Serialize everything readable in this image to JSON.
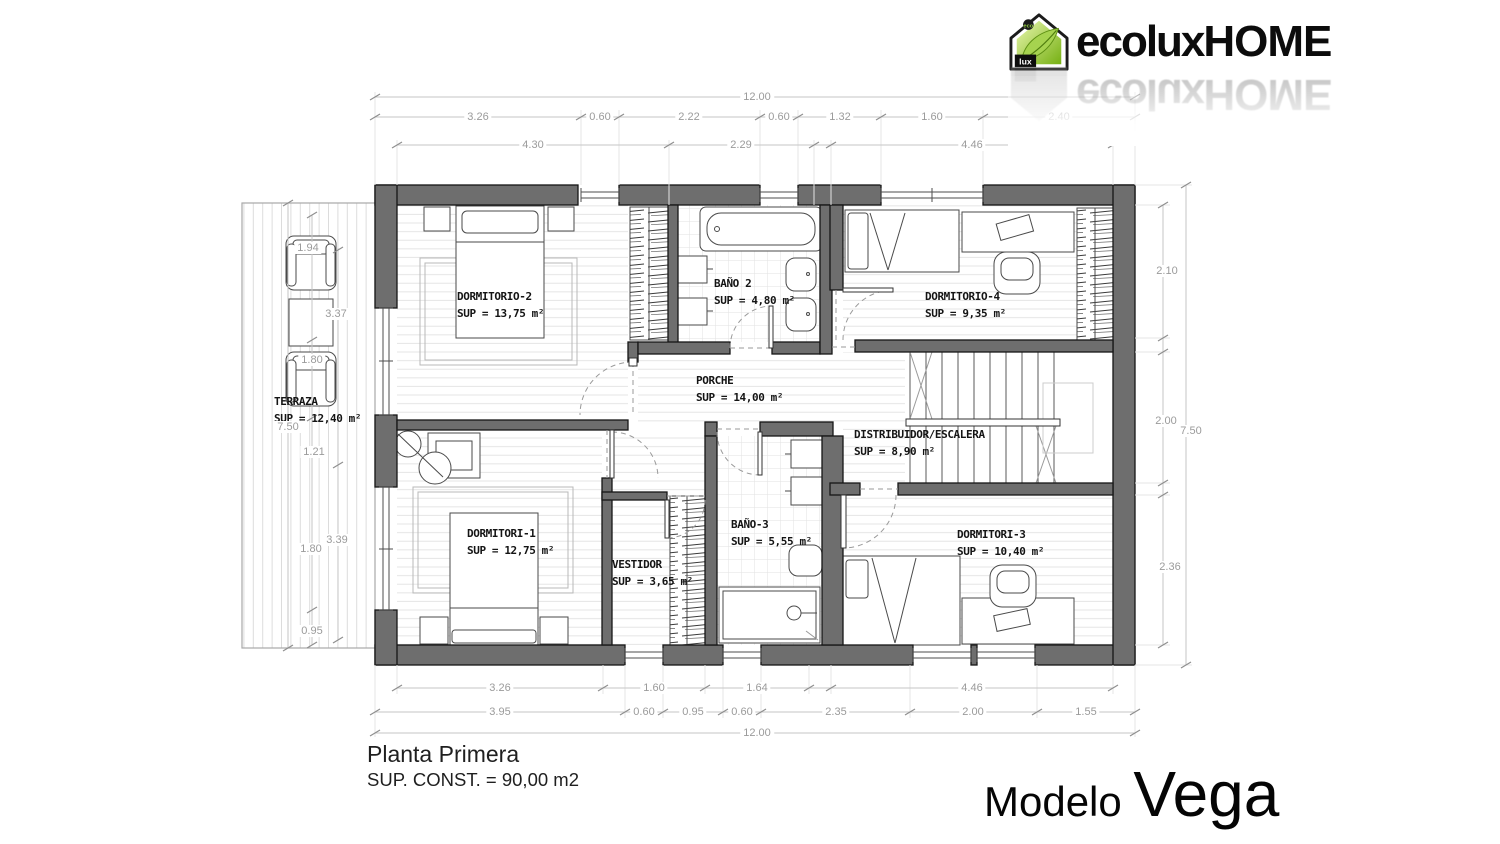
{
  "brand": {
    "icon_eco": "eco",
    "icon_lux": "lux",
    "wordmark_left": "ecolux",
    "wordmark_right": "HOME"
  },
  "footer": {
    "plan_title": "Planta Primera",
    "built_area": "SUP. CONST. =  90,00 m2",
    "model_prefix": "Modelo ",
    "model_name": "Vega"
  },
  "plan": {
    "rooms": [
      {
        "name": "DORMITORIO-2",
        "sup": "SUP = 13,75 m²",
        "x": 457,
        "y": 289
      },
      {
        "name": "BAÑO 2",
        "sup": "SUP = 4,80 m²",
        "x": 714,
        "y": 276
      },
      {
        "name": "DORMITORIO-4",
        "sup": "SUP = 9,35 m²",
        "x": 925,
        "y": 289
      },
      {
        "name": "TERRAZA",
        "sup": "SUP = 12,40 m²",
        "x": 274,
        "y": 394
      },
      {
        "name": "PORCHE",
        "sup": "SUP = 14,00 m²",
        "x": 696,
        "y": 373
      },
      {
        "name": "DISTRIBUIDOR/ESCALERA",
        "sup": "SUP = 8,90 m²",
        "x": 854,
        "y": 427
      },
      {
        "name": "DORMITORI-1",
        "sup": "SUP = 12,75 m²",
        "x": 467,
        "y": 526
      },
      {
        "name": "VESTIDOR",
        "sup": "SUP = 3,65 m²",
        "x": 612,
        "y": 557
      },
      {
        "name": "BAÑO-3",
        "sup": "SUP = 5,55 m²",
        "x": 731,
        "y": 517
      },
      {
        "name": "DORMITORI-3",
        "sup": "SUP = 10,40 m²",
        "x": 957,
        "y": 527
      }
    ],
    "dim_labels": [
      {
        "t": "12.00",
        "x": 757,
        "y": 97
      },
      {
        "t": "3.26",
        "x": 478,
        "y": 117
      },
      {
        "t": "0.60",
        "x": 600,
        "y": 117
      },
      {
        "t": "2.22",
        "x": 689,
        "y": 117
      },
      {
        "t": "0.60",
        "x": 779,
        "y": 117
      },
      {
        "t": "1.32",
        "x": 840,
        "y": 117
      },
      {
        "t": "1.60",
        "x": 932,
        "y": 117
      },
      {
        "t": "2.40",
        "x": 1059,
        "y": 117
      },
      {
        "t": "4.30",
        "x": 533,
        "y": 145
      },
      {
        "t": "2.29",
        "x": 741,
        "y": 145
      },
      {
        "t": "4.46",
        "x": 972,
        "y": 145
      },
      {
        "t": "3.26",
        "x": 500,
        "y": 688
      },
      {
        "t": "1.60",
        "x": 654,
        "y": 688
      },
      {
        "t": "1.64",
        "x": 757,
        "y": 688
      },
      {
        "t": "4.46",
        "x": 972,
        "y": 688
      },
      {
        "t": "3.95",
        "x": 500,
        "y": 712
      },
      {
        "t": "0.60",
        "x": 644,
        "y": 712
      },
      {
        "t": "0.95",
        "x": 693,
        "y": 712
      },
      {
        "t": "0.60",
        "x": 742,
        "y": 712
      },
      {
        "t": "2.35",
        "x": 836,
        "y": 712
      },
      {
        "t": "2.00",
        "x": 973,
        "y": 712
      },
      {
        "t": "1.55",
        "x": 1086,
        "y": 712
      },
      {
        "t": "12.00",
        "x": 757,
        "y": 733
      },
      {
        "t": "1.94",
        "x": 308,
        "y": 248
      },
      {
        "t": "3.37",
        "x": 336,
        "y": 314
      },
      {
        "t": "1.80",
        "x": 312,
        "y": 360
      },
      {
        "t": "7.50",
        "x": 288,
        "y": 427
      },
      {
        "t": "1.21",
        "x": 314,
        "y": 452
      },
      {
        "t": "3.39",
        "x": 337,
        "y": 540
      },
      {
        "t": "1.80",
        "x": 311,
        "y": 549
      },
      {
        "t": "0.95",
        "x": 312,
        "y": 631
      },
      {
        "t": "2.10",
        "x": 1167,
        "y": 271
      },
      {
        "t": "2.00",
        "x": 1166,
        "y": 421
      },
      {
        "t": "7.50",
        "x": 1191,
        "y": 431
      },
      {
        "t": "2.36",
        "x": 1170,
        "y": 567
      }
    ]
  },
  "colors": {
    "wall": "#6e6e6e",
    "dim": "#9b9b9b",
    "brand_green": "#8dc63f"
  }
}
